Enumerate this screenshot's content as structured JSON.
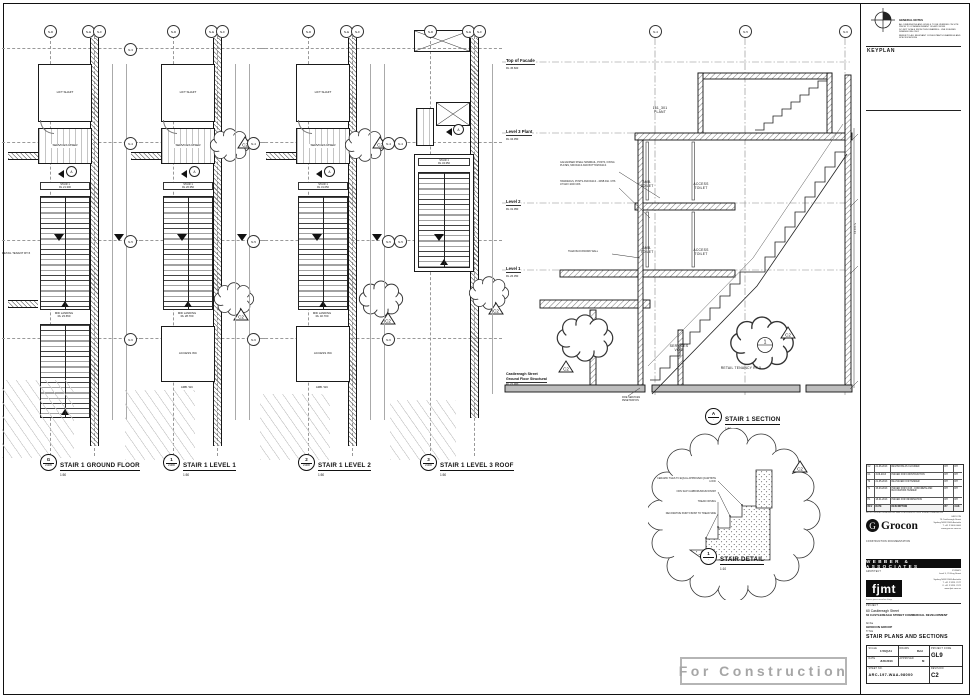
{
  "sheet": {
    "keyplan_label": "KEYPLAN",
    "stamp": "For Construction",
    "rev_marker": "C2",
    "general_notes": {
      "title": "GENERAL NOTES",
      "lines": [
        "ALL DIMENSIONS AND LEVELS TO BE VERIFIED ON SITE PRIOR TO COMMENCEMENT OF ANY WORK",
        "DO NOT SCALE FROM THIS DRAWING - USE FIGURED DIMENSIONS ONLY",
        "REFER TO ALL RELEVANT CONSULTANTS DRAWINGS AND SPECIFICATIONS"
      ]
    }
  },
  "plans": [
    {
      "ref": "G",
      "sheet_ref": "21005",
      "title": "STAIR 1 GROUND FLOOR",
      "scale": "1:50",
      "grid_top": [
        "N-D",
        "N-E",
        "N-F"
      ],
      "grid_side": [
        "N-3",
        "N-4",
        "N-5",
        "N-6"
      ],
      "lift": "LIFT SHAFT",
      "services": "SERVICES RISER",
      "section_ref": "A",
      "stair": "STAIR 1",
      "stair_rl": "RL 21.300",
      "mid": "MID LANDING",
      "mid_rl": "RL 23.650",
      "extra": "RETAIL TENANT RT-5"
    },
    {
      "ref": "1",
      "sheet_ref": "21006",
      "title": "STAIR 1 LEVEL 1",
      "scale": "1:50",
      "grid_top": [
        "N-D",
        "N-E",
        "N-F"
      ],
      "grid_side": [
        "N-3",
        "N-4",
        "N-5",
        "N-6"
      ],
      "lift": "LIFT SHAFT",
      "services": "SERVICES RISER",
      "section_ref": "A",
      "stair": "STAIR 1",
      "stair_rl": "RL 26.350",
      "mid": "MID LANDING",
      "mid_rl": "RL 28.700",
      "wc1": "ACCESS WC",
      "wc2": "AMB. WC"
    },
    {
      "ref": "2",
      "sheet_ref": "21006",
      "title": "STAIR 1 LEVEL 2",
      "scale": "1:50",
      "grid_top": [
        "N-D",
        "N-E",
        "N-F"
      ],
      "grid_side": [
        "N-3",
        "N-4",
        "N-5",
        "N-6"
      ],
      "lift": "LIFT SHAFT",
      "services": "SERVICES RISER",
      "section_ref": "A",
      "stair": "STAIR 1",
      "stair_rl": "RL 31.050",
      "mid": "MID LANDING",
      "mid_rl": "RL 32.700",
      "wc1": "ACCESS WC",
      "wc2": "AMB. WC"
    },
    {
      "ref": "3",
      "sheet_ref": "21006",
      "title": "STAIR 1 LEVEL 3 ROOF",
      "scale": "1:50",
      "grid_top": [
        "N-D",
        "N-E",
        "N-F"
      ],
      "grid_side": [
        "N-3",
        "N-4",
        "N-5",
        "N-6"
      ],
      "section_ref": "A",
      "stair": "STAIR 1",
      "stair_rl": "RL 34.350"
    }
  ],
  "section": {
    "ref": "A",
    "sheet_ref": "-",
    "title": "STAIR 1 SECTION",
    "scale": "1:50",
    "grid_top": [
      "N-4",
      "N-5",
      "N-6"
    ],
    "levels": [
      {
        "name": "Top of Facade",
        "rl": "RL 45.600"
      },
      {
        "name": "Level 3 Plant",
        "rl": "RL 34.350"
      },
      {
        "name": "Level 2",
        "rl": "RL 31.050"
      },
      {
        "name": "Level 1",
        "rl": "RL 26.350"
      }
    ],
    "ground": {
      "line1": "Castlereagh Street",
      "line2": "Ground Floor Structural",
      "rl": "RL 21.300"
    },
    "rooms": {
      "plant_no": "161_301",
      "plant": "PLANT",
      "amb1": "AMB.",
      "amb2": "TOILET",
      "access1": "ACCESS",
      "access2": "TOILET",
      "services1": "SERVICES",
      "services2": "VOID",
      "retail": "RETAIL TENANCY RT-5"
    },
    "notes": {
      "handrail": "GALVANISED STEEL HANDRAIL, POSTS, FIXING PLATES, MID RAILS AND BOTTOM RAILS",
      "posts": "HANDRAILS, POSTS AND RAILS - 40NB DIA. CHS AT MAX 1000 CRS",
      "blockwork": "TILED BLOCKWORK WALL",
      "fire": "FIRE SERVICES PENETRATION"
    },
    "dim": "5,334.93",
    "detail_ref": "1"
  },
  "detail": {
    "ref": "1",
    "sheet_ref": "-",
    "title": "STAIR DETAIL",
    "scale": "1:10",
    "callouts": [
      "CERAMIC TILES TO EQUAL APPROVED QUARTZITE LOOK",
      "NON SLIP CARBORUNDUM FINISH",
      "TREAD NOSING",
      "DECORATIVE PAINT FINISH TO TREAD SIDE"
    ]
  },
  "titleblock": {
    "revisions": {
      "headers": [
        "REV",
        "DATE",
        "DESCRIPTION",
        "BY",
        "CHK"
      ],
      "rows": [
        [
          "C2",
          "21-06-2013",
          "REVISIONS AS CLOUDED",
          "DH",
          "DH"
        ],
        [
          "C1",
          "3-06-2013",
          "ISSUED FOR CONSTRUCTION",
          "DH",
          "DH"
        ],
        [
          "T2",
          "21-05-2013",
          "RE-ISSUED FOR TENDER",
          "DH",
          "DH"
        ],
        [
          "T1",
          "15-03-2013",
          "ISSUED FOR CC15 - CONCRETE AND BLOCKWORK TENDER",
          "DH",
          "DH"
        ],
        [
          "P1",
          "18-01-2013",
          "ISSUED FOR INFORMATION",
          "DH",
          "DH"
        ]
      ],
      "note": "NOTE: FIGURED DIMENSIONS TAKE PRECEDENCE OVER SCALED DIMENSIONS"
    },
    "client": {
      "logo": "Grocon",
      "caption": "CONSTRUCTION DOCUMENTATION",
      "address": [
        "GROCON",
        "75 Castlereagh Street",
        "Sydney NSW 2000 Australia",
        "T +61 2 9000 0000",
        "www.grocon.com.au"
      ]
    },
    "consultant": {
      "name": "WEBBER & ASSOCIATES",
      "role": "ARCHITECT",
      "address": [
        "SYDNEY",
        "Level 5, 70 King Street"
      ]
    },
    "architect": {
      "logo": "fjmt",
      "address": [
        "Sydney NSW 2000 Australia",
        "T +61 2 9251 7077",
        "F +61 2 9251 7072",
        "www.fjmt.com.au"
      ],
      "firm": "francis-jones morehen thorp"
    },
    "project": {
      "label": "PROJECT",
      "line1": "60 Castlereagh Street",
      "line2": "60 CASTLEREAGH STREET COMMERCIAL DEVELOPMENT",
      "line3": "for the",
      "line4": "GROCON GROUP"
    },
    "title": {
      "label": "TITLE",
      "value": "STAIR PLANS AND SECTIONS"
    },
    "meta": {
      "scale_label": "SCALE",
      "scale": "1:50@A1",
      "drawn_label": "DRAWN",
      "drawn": "RvH",
      "date_label": "DATE",
      "date": "JUN 2013",
      "approved_label": "APPROVED",
      "approved": "M",
      "code_label": "PROJECT CODE",
      "code": "GL9",
      "sheet_label": "SHEET NO.",
      "sheet": "ARC-197-WAA-98000",
      "rev_label": "REVISION",
      "rev": "C2"
    }
  }
}
